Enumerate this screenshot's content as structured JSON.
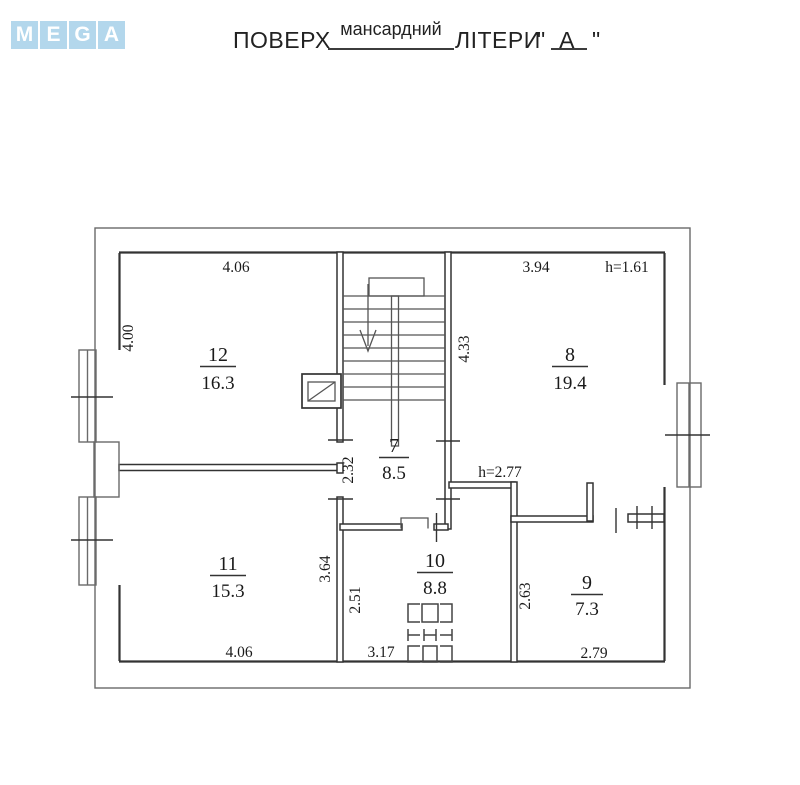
{
  "logo": {
    "tiles": [
      "M",
      "E",
      "G",
      "A"
    ],
    "tile_color": "#b3d7ec"
  },
  "title": {
    "floor_label": "ПОВЕРХ",
    "floor_value": "мансардний",
    "letters_label": "ЛІТЕРИ",
    "open_quote": "\"",
    "letters_value": "А",
    "close_quote": "\""
  },
  "plan": {
    "rooms": [
      {
        "number": "12",
        "area": "16.3"
      },
      {
        "number": "8",
        "area": "19.4"
      },
      {
        "number": "7",
        "area": "8.5"
      },
      {
        "number": "11",
        "area": "15.3"
      },
      {
        "number": "10",
        "area": "8.8"
      },
      {
        "number": "9",
        "area": "7.3"
      }
    ],
    "dimensions": {
      "top_width_left": "4.06",
      "top_width_right": "3.94",
      "ceiling_height_top": "h=1.61",
      "left_height": "4.00",
      "stair_height": "4.33",
      "hall_height": "2.32",
      "ceiling_height_mid": "h=2.77",
      "room11_height": "3.64",
      "room10_height": "2.51",
      "room9_height": "2.63",
      "bottom_width_left": "4.06",
      "bottom_width_mid": "3.17",
      "bottom_width_right": "2.79"
    }
  },
  "colors": {
    "wall": "#333333",
    "thin_line": "#6a6a6a",
    "text": "#1a1a1a"
  }
}
